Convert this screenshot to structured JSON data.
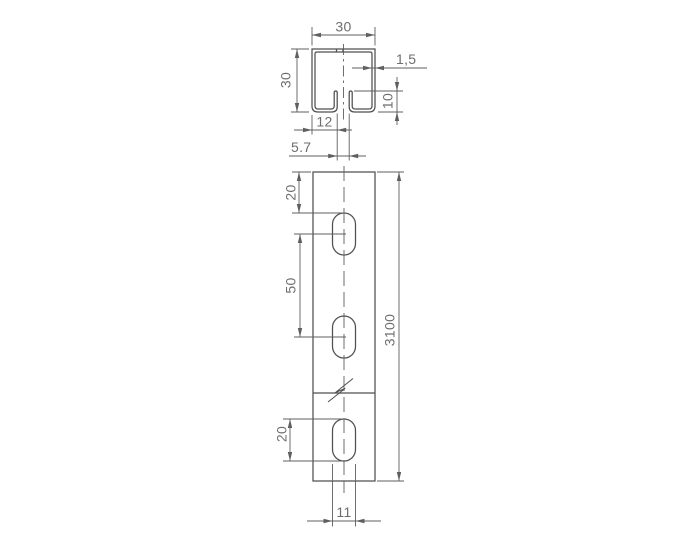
{
  "drawing": {
    "background": "#ffffff",
    "line_color": "#4f4f4f",
    "dim_color": "#5f5f5f",
    "text_color": "#6e6e6e",
    "section_view": {
      "description": "C-channel cross-section with bottom slot and upturned lips",
      "dims": {
        "outer_width": "30",
        "outer_height": "30",
        "wall_thickness": "1,5",
        "lip_height": "10",
        "edge_to_slot": "12",
        "slot_opening": "5.7"
      }
    },
    "front_view": {
      "description": "Channel length view with slotted holes and break symbol",
      "dims": {
        "end_to_first_slot": "20",
        "slot_pitch": "50",
        "slot_length": "20",
        "slot_width": "11",
        "total_length": "3100"
      }
    }
  }
}
